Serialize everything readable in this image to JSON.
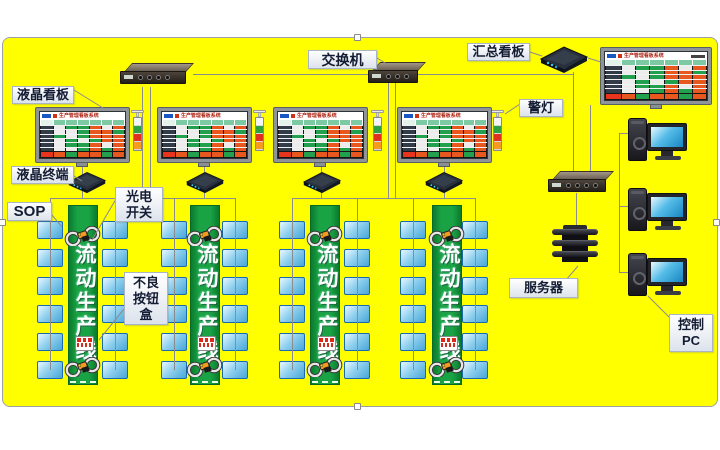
{
  "canvas": {
    "background": "#ffff00",
    "border": "#9aa0a6"
  },
  "labels": {
    "lcd_board": "液晶看板",
    "lcd_terminal": "液晶终端",
    "sop": "SOP",
    "switch": "交换机",
    "summary_board": "汇总看板",
    "warning_light": "警灯",
    "photo_switch": [
      "光电",
      "开关"
    ],
    "defect_button_box": [
      "不良",
      "按钮",
      "盒"
    ],
    "server": "服务器",
    "control_pc": [
      "控制",
      "PC"
    ]
  },
  "production_line": {
    "text": "流动生产线",
    "count": 4,
    "stations_per_side": 6
  },
  "kanban": {
    "title": "生产管理看板系统",
    "cell_colors": {
      "w": "#ececec",
      "g": "#22a04e",
      "r": "#e8571e",
      "R": "#e8341c"
    },
    "rows": [
      [
        "w",
        "g",
        "g",
        "r",
        "w",
        "r"
      ],
      [
        "w",
        "w",
        "g",
        "r",
        "r",
        "g"
      ],
      [
        "g",
        "w",
        "g",
        "r",
        "r",
        "r"
      ],
      [
        "w",
        "g",
        "w",
        "g",
        "r",
        "r"
      ],
      [
        "w",
        "g",
        "g",
        "r",
        "w",
        "r"
      ],
      [
        "w",
        "w",
        "g",
        "r",
        "g",
        "r"
      ]
    ],
    "bottom_row": [
      "r",
      "g",
      "r",
      "r",
      "g",
      "r"
    ]
  },
  "status_tower": {
    "segments": [
      "#f4f4f4",
      "#2ea043",
      "#e03020",
      "#f59a23"
    ]
  },
  "wire_color": "#8c8c8c"
}
